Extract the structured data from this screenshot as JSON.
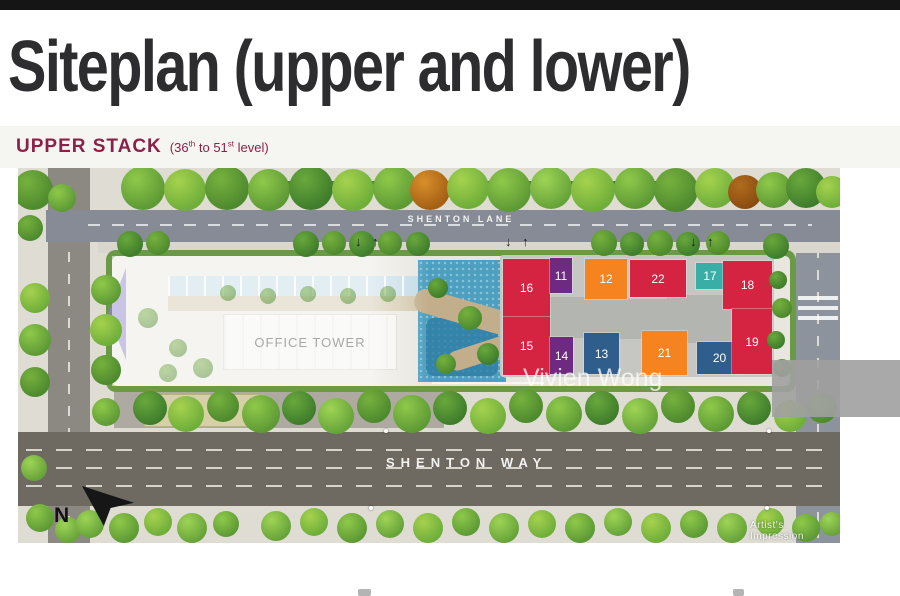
{
  "page": {
    "title": "Siteplan (upper and lower)"
  },
  "heading": {
    "title": "UPPER STACK",
    "range_pre": "(36",
    "range_sup1": "th",
    "range_mid": " to 51",
    "range_sup2": "st",
    "range_post": " level)"
  },
  "map": {
    "lane_label": "SHENTON LANE",
    "way_label": "SHENTON WAY",
    "office_label": "OFFICE TOWER",
    "north_label": "N",
    "watermark_name": "Vivien Wong",
    "watermark_note": "Artist's Impression",
    "arrow_down": "↓",
    "arrow_up": "↑",
    "traffic_arrows": [
      337,
      487,
      672
    ],
    "colors": {
      "red": "#d52441",
      "purple": "#6e2a80",
      "orange": "#f5831f",
      "teal": "#39aea6",
      "blue": "#2f5e8d",
      "core": "#b3b5b1"
    },
    "units": [
      {
        "no": "16",
        "x": 485,
        "y": 91,
        "w": 47,
        "h": 58,
        "color": "red"
      },
      {
        "no": "15",
        "x": 485,
        "y": 149,
        "w": 47,
        "h": 58,
        "color": "red"
      },
      {
        "no": "11",
        "x": 532,
        "y": 90,
        "w": 22,
        "h": 35,
        "color": "purple"
      },
      {
        "no": "12",
        "x": 567,
        "y": 91,
        "w": 42,
        "h": 40,
        "color": "orange"
      },
      {
        "no": "22",
        "x": 612,
        "y": 92,
        "w": 56,
        "h": 37,
        "color": "red"
      },
      {
        "no": "17",
        "x": 678,
        "y": 95,
        "w": 28,
        "h": 26,
        "color": "teal"
      },
      {
        "no": "18",
        "x": 705,
        "y": 93,
        "w": 49,
        "h": 48,
        "color": "red"
      },
      {
        "no": "14",
        "x": 532,
        "y": 169,
        "w": 23,
        "h": 37,
        "color": "purple"
      },
      {
        "no": "13",
        "x": 566,
        "y": 165,
        "w": 35,
        "h": 41,
        "color": "blue"
      },
      {
        "no": "21",
        "x": 624,
        "y": 163,
        "w": 45,
        "h": 44,
        "color": "orange"
      },
      {
        "no": "20",
        "x": 679,
        "y": 174,
        "w": 45,
        "h": 32,
        "color": "blue"
      },
      {
        "no": "19",
        "x": 714,
        "y": 141,
        "w": 40,
        "h": 65,
        "color": "red"
      }
    ]
  }
}
